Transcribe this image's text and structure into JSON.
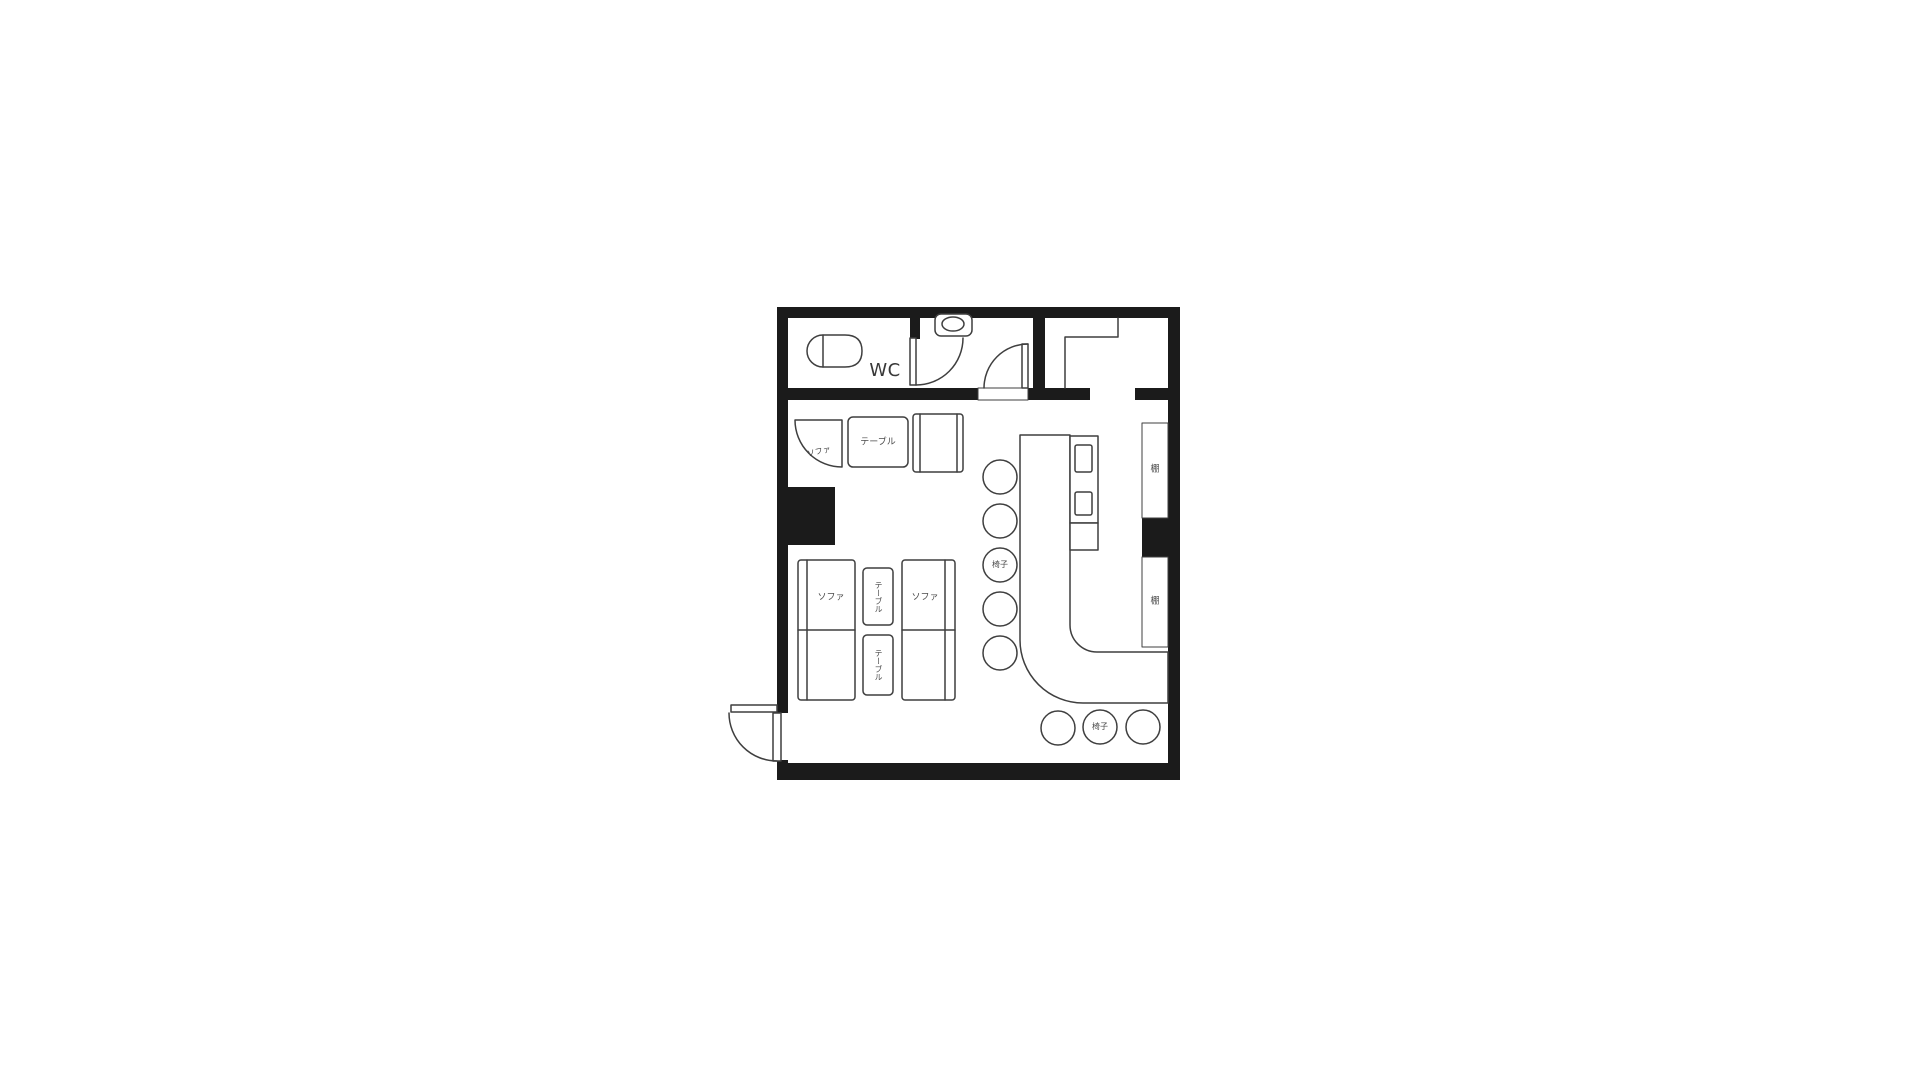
{
  "document": {
    "type": "floor-plan",
    "background": "#ffffff"
  },
  "colors": {
    "wall": "#1b1b1b",
    "line": "#3f3f3f",
    "text": "#4a4a4a",
    "fill": "#ffffff"
  },
  "rooms": {
    "wc_label": "WC"
  },
  "furniture": {
    "corner_sofa_label": "ソファ",
    "corner_table_label": "テーブル",
    "sofa_left_label": "ソファ",
    "sofa_right_label": "ソファ",
    "table_upper_label": "テーブル",
    "table_lower_label": "テーブル",
    "counter_chair_label": "椅子",
    "floor_chair_label": "椅子",
    "shelf_upper_label": "棚",
    "shelf_lower_label": "棚"
  }
}
